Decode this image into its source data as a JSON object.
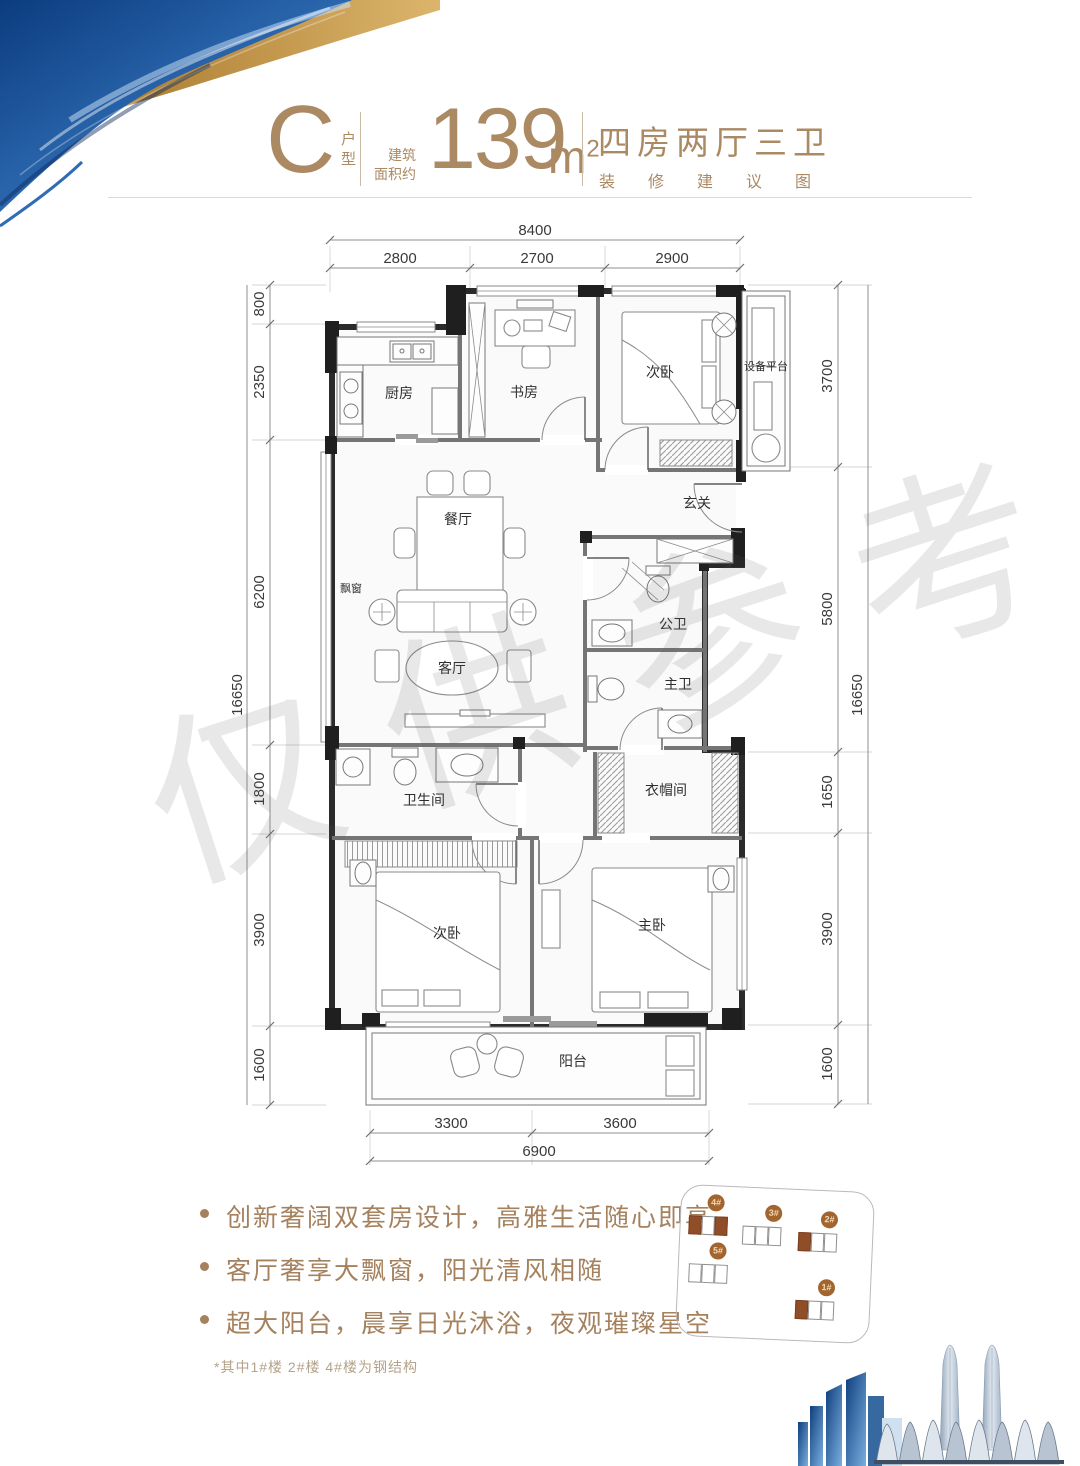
{
  "header": {
    "type_letter": "C",
    "type_char1": "户",
    "type_char2": "型",
    "area_label1": "建筑",
    "area_label2": "面积约",
    "area_value": "139",
    "area_unit": "m",
    "area_exp": "2",
    "rooms_title": "四房两厅三卫",
    "subtitle": "装修建议图"
  },
  "watermark": {
    "text": "仅供参考"
  },
  "plan": {
    "rooms": {
      "kitchen": "厨房",
      "study": "书房",
      "bedroom_top": "次卧",
      "equipment": "设备平台",
      "entry": "玄关",
      "dining": "餐厅",
      "bay_window": "飘窗",
      "living": "客厅",
      "guest_bath": "公卫",
      "master_bath": "主卫",
      "bathroom": "卫生间",
      "cloakroom": "衣帽间",
      "bedroom2": "次卧",
      "master_bedroom": "主卧",
      "balcony": "阳台"
    },
    "dims": {
      "top_total": "8400",
      "top": [
        "2800",
        "2700",
        "2900"
      ],
      "left_total": "16650",
      "left": [
        "800",
        "2350",
        "6200",
        "1800",
        "3900",
        "1600"
      ],
      "right_total": "16650",
      "right": [
        "3700",
        "5800",
        "1650",
        "3900",
        "1600"
      ],
      "bottom_total": "6900",
      "bottom": [
        "3300",
        "3600"
      ]
    }
  },
  "features": {
    "bullets": [
      "创新奢阔双套房设计，高雅生活随心即享",
      "客厅奢享大飘窗，阳光清风相随",
      "超大阳台，晨享日光沐浴，夜观璀璨星空"
    ],
    "footnote": "*其中1#楼 2#楼 4#楼为钢结构"
  },
  "siteplan": {
    "buildings": [
      {
        "label": "4#"
      },
      {
        "label": "3#"
      },
      {
        "label": "2#"
      },
      {
        "label": "5#"
      },
      {
        "label": "1#"
      }
    ]
  },
  "colors": {
    "accent": "#ab8963",
    "brick": "#8f4e28",
    "badge": "#a2652f"
  }
}
